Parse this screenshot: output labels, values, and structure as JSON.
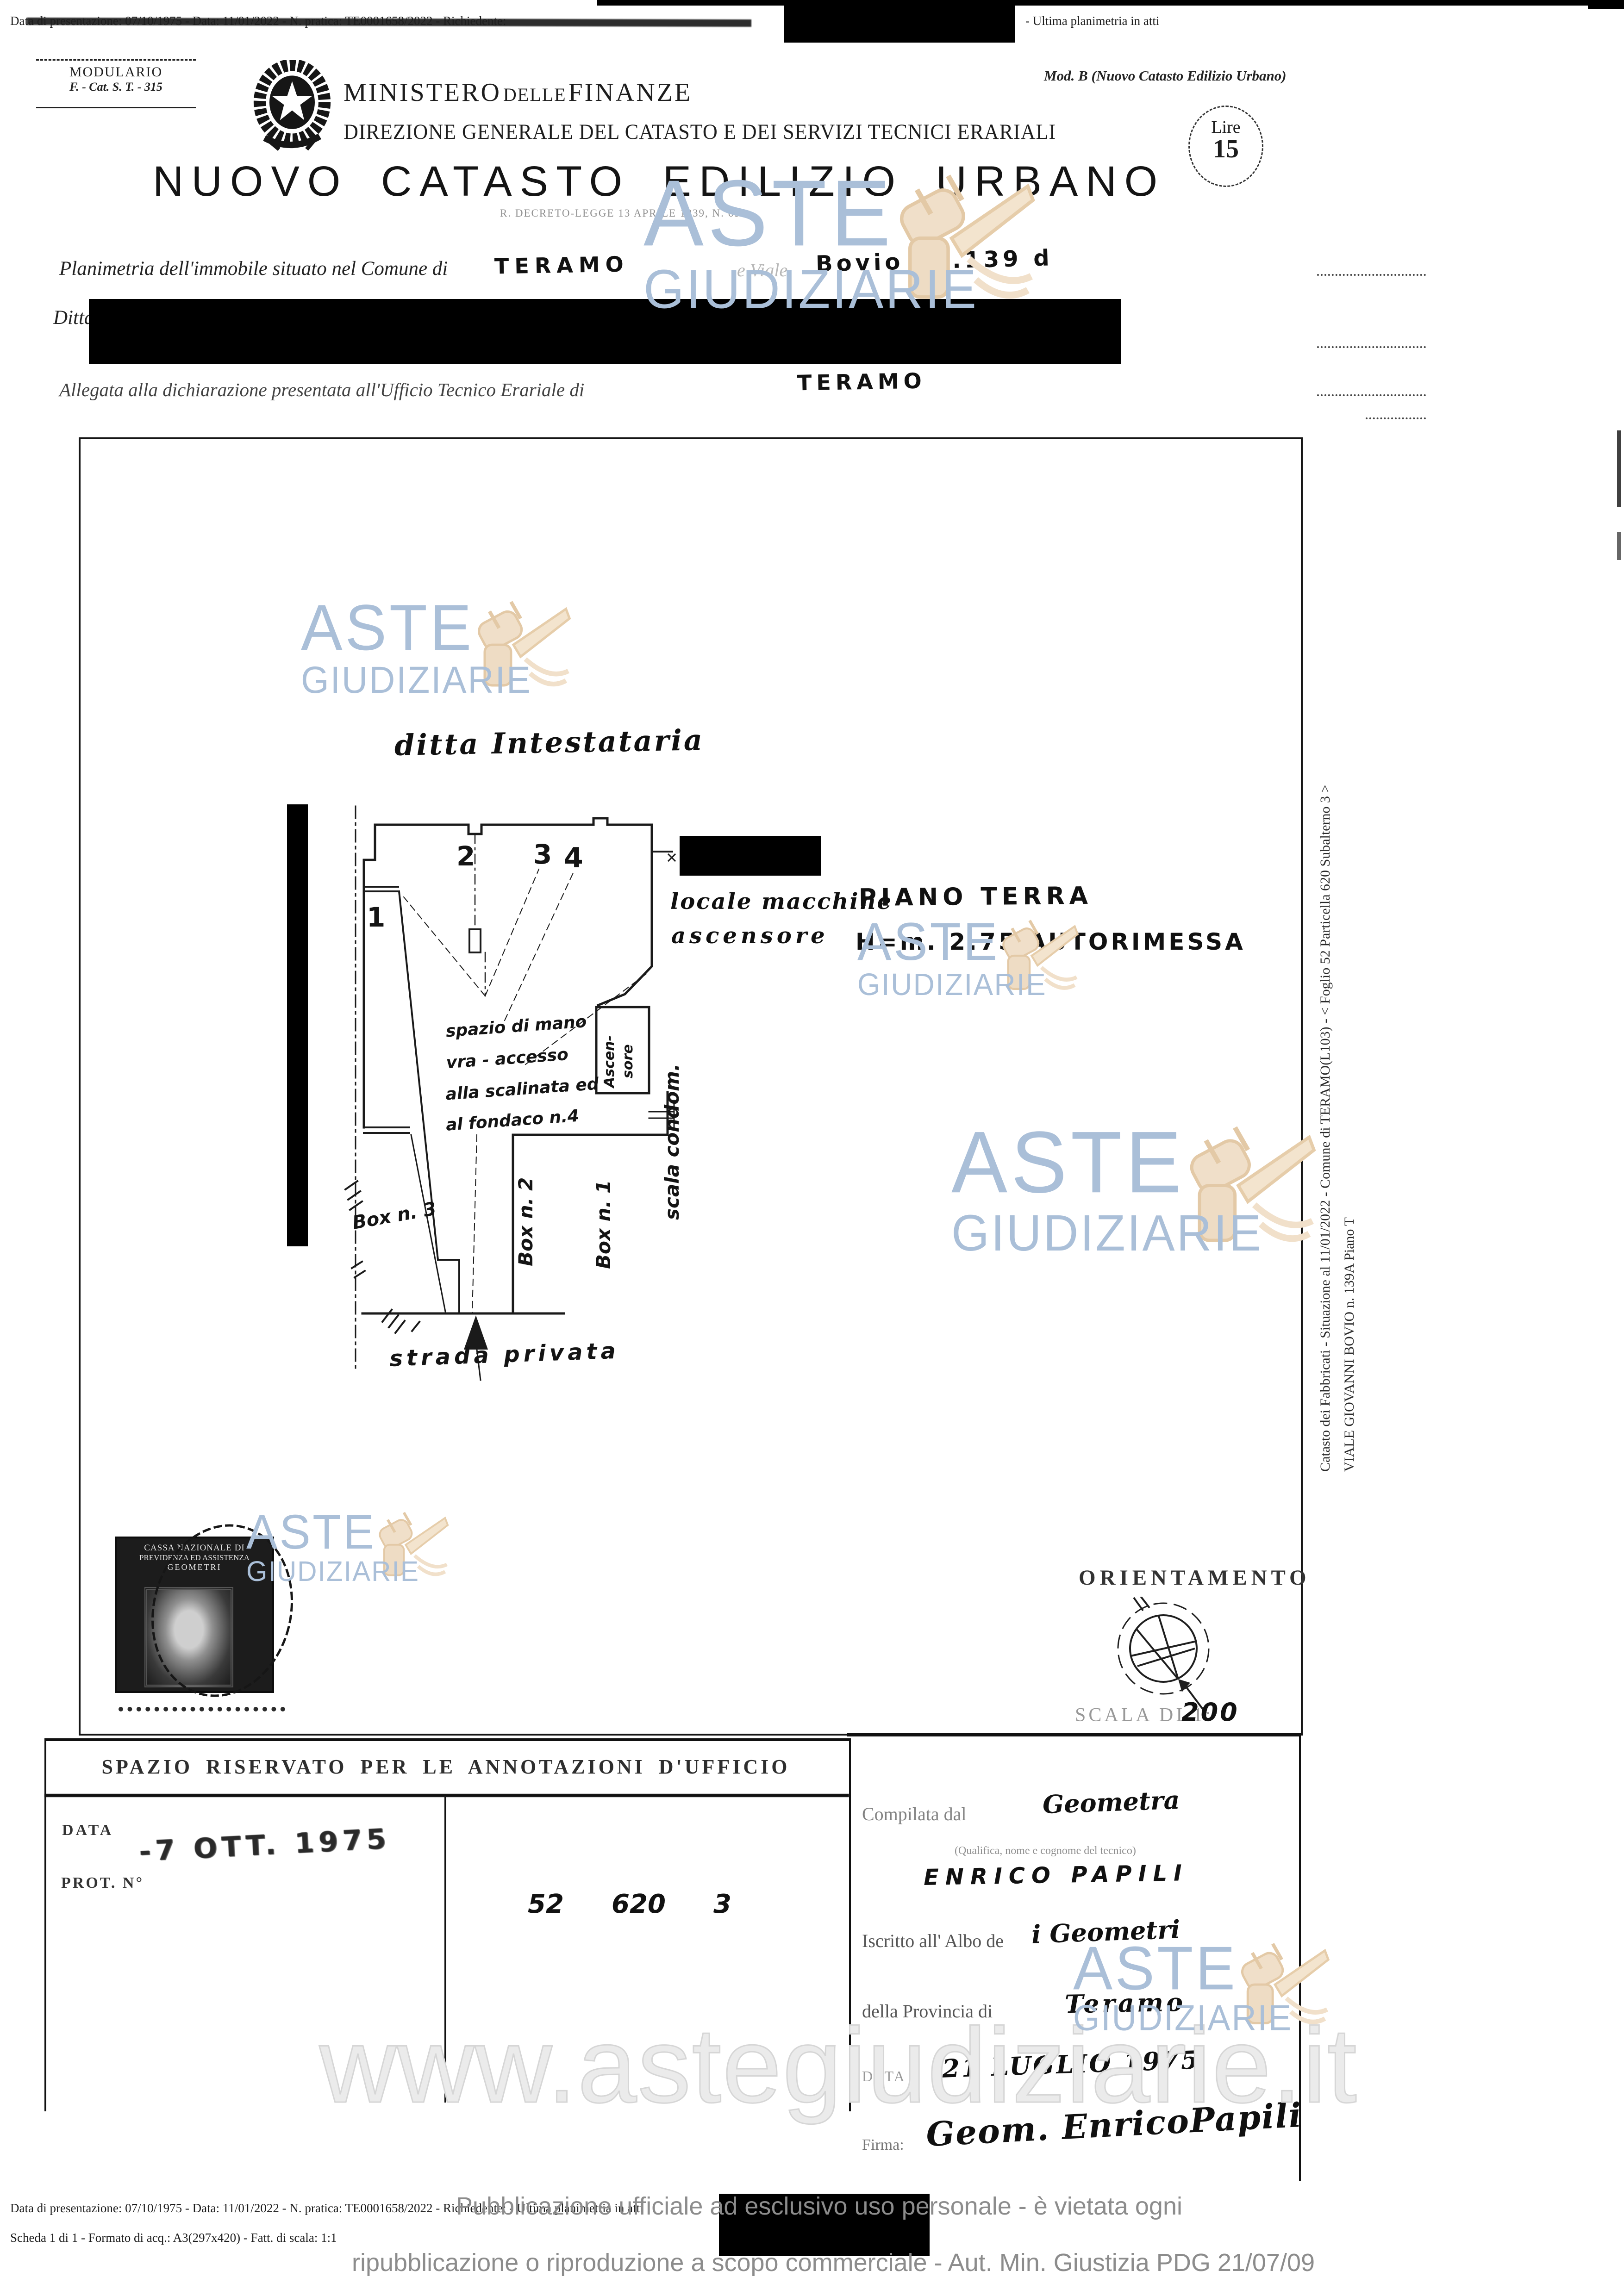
{
  "top_bar": {
    "prefix": "Data di presentazione: 07/10/1975 - Data: 11/01/2022 - N. pratica: TE0001658/2022 - Richiedente:",
    "suffix": "- Ultima planimetria in atti"
  },
  "header": {
    "modulario_line1": "MODULARIO",
    "modulario_line2": "F. - Cat. S. T. - 315",
    "mod_b": "Mod. B (Nuovo Catasto Edilizio Urbano)",
    "ministry_1": "MINISTERO",
    "ministry_2": "DELLE",
    "ministry_3": "FINANZE",
    "direzione": "DIREZIONE GENERALE DEL CATASTO E DEI SERVIZI TECNICI ERARIALI",
    "title": "NUOVO CATASTO EDILIZIO URBANO",
    "subtitle": "R. DECRETO-LEGGE 13 APRILE 1939, N. 652",
    "lire_label": "Lire",
    "lire_value": "15"
  },
  "form": {
    "line1_label": "Planimetria dell'immobile situato nel Comune di",
    "line1_value": "TERAMO",
    "line1_label2": "e Viale",
    "line1_value2": "Bovio N°.139 d",
    "ditta_label": "Ditta",
    "line3_label": "Allegata alla dichiarazione presentata all'Ufficio Tecnico Erariale di",
    "line3_value": "TERAMO"
  },
  "plan": {
    "ditta_note": "ditta Intestataria",
    "room1": "1",
    "room2": "2",
    "room3": "3",
    "room4": "4",
    "locale_line1": "locale macchine",
    "locale_line2": "ascensore",
    "piano_line1": "PIANO TERRA",
    "piano_line2": "H=m. 2.75   AUTORIMESSA",
    "spazio_1": "spazio di mano",
    "spazio_2": "vra  -  accesso",
    "spazio_3": "alla scalinata ed",
    "spazio_4": "al fondaco n.4",
    "ascensore_1": "Ascen-",
    "ascensore_2": "sore",
    "scala": "scala condom.",
    "box1": "Box n. 1",
    "box2": "Box n. 2",
    "box3": "Box n. 3",
    "strada": "strada privata"
  },
  "orientamento": {
    "title": "ORIENTAMENTO",
    "scala_label": "SCALA DI 1:",
    "scala_value": "200"
  },
  "stamp": {
    "line1": "CASSA NAZIONALE DI",
    "line2": "PREVIDENZA ED ASSISTENZA",
    "line3": "GEOMETRI"
  },
  "annotations": {
    "header": "SPAZIO RISERVATO PER LE ANNOTAZIONI D'UFFICIO",
    "data_label": "DATA",
    "prot_label": "PROT. N°",
    "stamp_date": "-7 OTT. 1975",
    "num1": "52",
    "num2": "620",
    "num3": "3"
  },
  "compiler": {
    "compilata_label": "Compilata dal",
    "compilata_value": "Geometra",
    "small_note": "(Qualifica, nome e cognome del tecnico)",
    "name": "ENRICO PAPILI",
    "albo_label": "Iscritto all' Albo de",
    "albo_value": "i  Geometri",
    "provincia_label": "della Provincia di",
    "provincia_value": "Teramo",
    "data_label": "DATA",
    "data_value": "21 LUGLIO 1975",
    "firma_label": "Firma:",
    "firma_value": "Geom. EnricoPapili"
  },
  "watermarks": {
    "aste": "ASTE",
    "giudiziarie": "GIUDIZIARIE",
    "url": "www.astegiudiziarie.it"
  },
  "margin": {
    "line1": "Catasto dei Fabbricati - Situazione al 11/01/2022 - Comune di TERAMO(L103) - < Foglio 52 Particella 620 Subalterno 3 >",
    "line2": "VIALE GIOVANNI BOVIO n. 139A Piano T"
  },
  "footer": {
    "line1": "Data di presentazione: 07/10/1975 - Data: 11/01/2022 - N. pratica: TE0001658/2022 - Richiedente:                                   - Ultima planimetria in atti",
    "line2": "Scheda 1 di 1 - Formato di acq.: A3(297x420) - Fatt. di scala: 1:1",
    "notice1": "Pubblicazione ufficiale ad esclusivo uso personale - è vietata ogni",
    "notice2": "ripubblicazione o riproduzione a scopo commerciale - Aut. Min. Giustizia PDG 21/07/09"
  },
  "colors": {
    "watermark_blue": "#aabfd8",
    "gavel_tan": "#eedcc4",
    "paper": "#ffffff",
    "ink": "#1a1a1a",
    "overlay_gray": "#8c8c8c"
  }
}
